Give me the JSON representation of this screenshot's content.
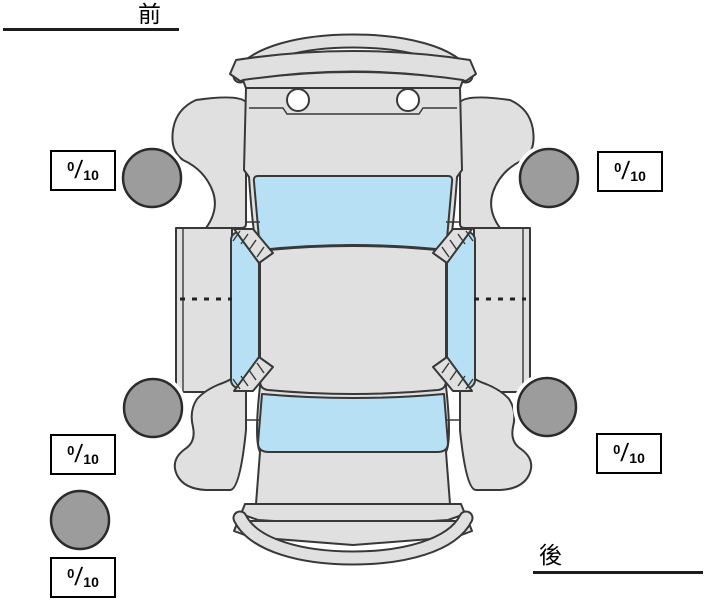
{
  "labels": {
    "front": "前",
    "rear": "後"
  },
  "ratings": {
    "front_left": {
      "value": "0",
      "separator": "/",
      "max": "10"
    },
    "front_right": {
      "value": "0",
      "separator": "/",
      "max": "10"
    },
    "rear_left": {
      "value": "0",
      "separator": "/",
      "max": "10"
    },
    "rear_right": {
      "value": "0",
      "separator": "/",
      "max": "10"
    },
    "spare": {
      "value": "0",
      "separator": "/",
      "max": "10"
    }
  },
  "colors": {
    "background": "#ffffff",
    "body": "#e0e0e0",
    "glass": "#b7e0f4",
    "tire": "#9c9c9c",
    "outline": "#383838",
    "box_border": "#000000",
    "label_text": "#000000"
  },
  "icons": {
    "car": "car-top-view-diagram",
    "tire": "tire-circle"
  }
}
